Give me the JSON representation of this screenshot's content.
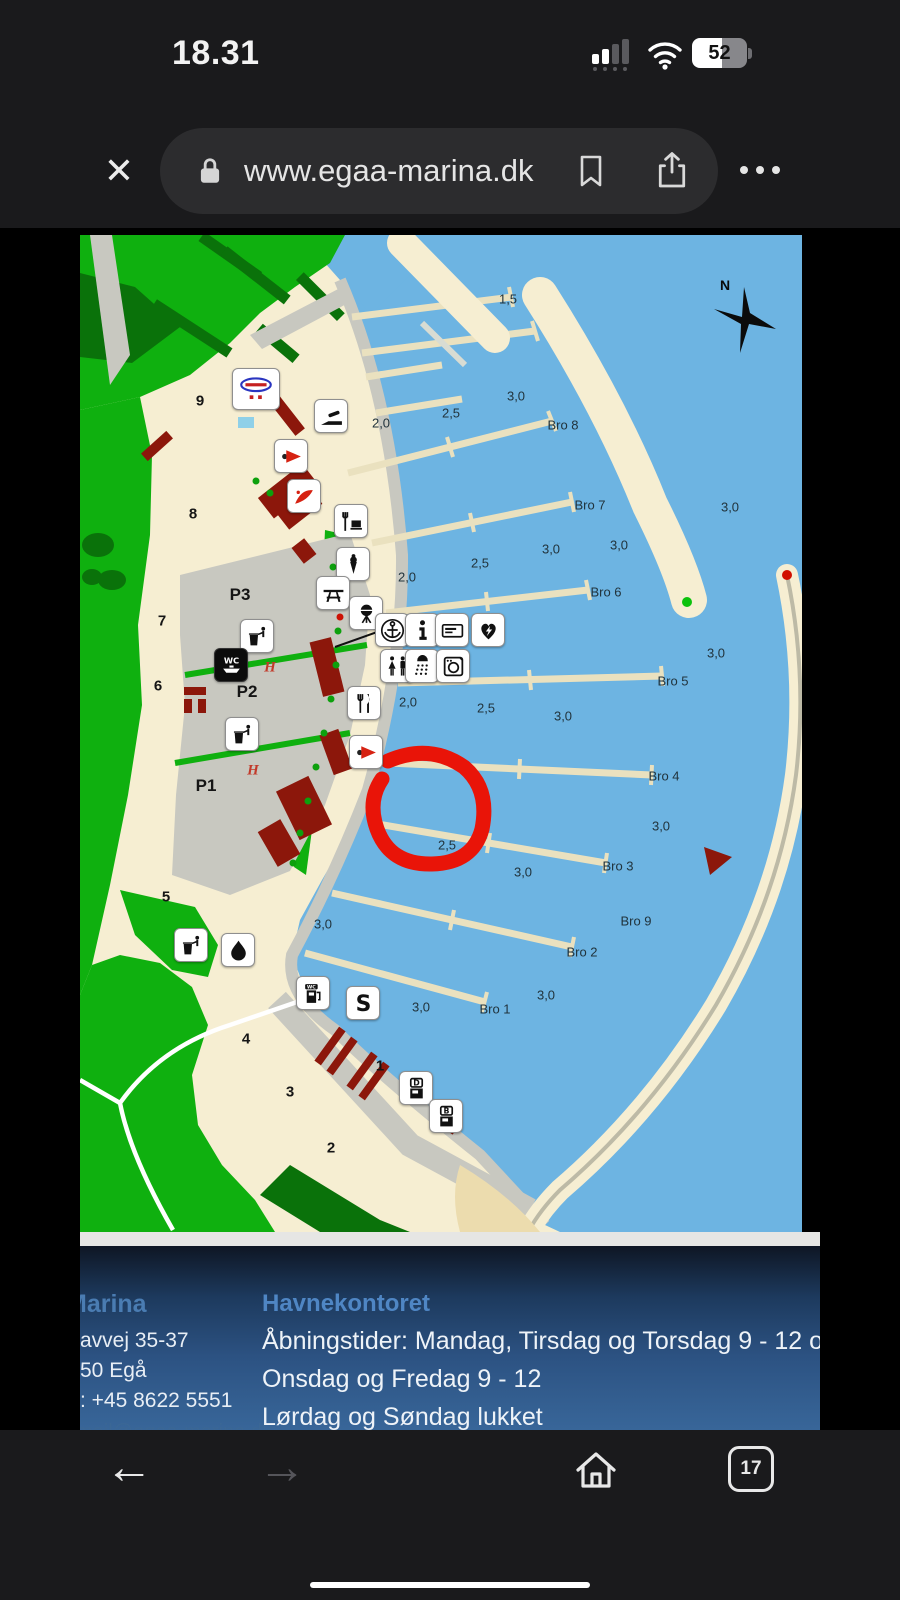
{
  "status_bar": {
    "time": "18.31",
    "battery_percent": "52"
  },
  "browser": {
    "url": "www.egaa-marina.dk"
  },
  "map": {
    "compass": "N",
    "h_marker": "H",
    "depths": [
      "1,5",
      "2,0",
      "2,5",
      "3,0",
      "3,0",
      "3,0",
      "3,0",
      "2,5",
      "2,0",
      "3,0",
      "3,0",
      "2,5",
      "2,0",
      "3,0",
      "3,0",
      "2,5",
      "3,0",
      "3,0",
      "3,0"
    ],
    "piers": [
      "Bro 8",
      "Bro 7",
      "Bro 6",
      "Bro 5",
      "Bro 4",
      "Bro 3",
      "Bro 9",
      "Bro 2",
      "Bro 1"
    ],
    "areas": [
      "9",
      "8",
      "7",
      "6",
      "5",
      "4",
      "3",
      "2",
      "1"
    ],
    "parking": [
      "P3",
      "P2",
      "P1"
    ],
    "icon_names": [
      "marina-logo-sign",
      "slipway-icon",
      "club-pennant-icon",
      "sailing-school-icon",
      "restaurant-cafe-icon",
      "ice-cream-icon",
      "picnic-table-icon",
      "grill-icon",
      "harbour-office-anchor-icon",
      "information-icon",
      "payment-card-icon",
      "defibrillator-icon",
      "toilets-icon",
      "shower-icon",
      "laundry-icon",
      "restaurant-icon",
      "club-pennant-2-icon",
      "waste-icon",
      "wc-pumpout-icon",
      "waste-2-icon",
      "waste-3-icon",
      "drinking-water-icon",
      "fuel-wc-pumpout-icon",
      "crane-hook-icon",
      "diesel-pump-icon",
      "benzin-pump-icon"
    ],
    "colors": {
      "water": "#6db4e2",
      "land": "#f6eed2",
      "green": "#0fb00f",
      "dark_green": "#0a720a",
      "gray": "#c8c8c0",
      "building": "#8c170b",
      "annotation": "#e91408"
    }
  },
  "footer": {
    "company": {
      "title": "Marina",
      "address1": "avvej 35-37",
      "address2": "50 Egå",
      "phone": ": +45 8622 5551",
      "email": "mail@egaa-marina.dk"
    },
    "office": {
      "title": "Havnekontoret",
      "hours1": "Åbningstider: Mandag, Tirsdag og Torsdag 9 - 12 og 13 - 1",
      "hours2": "Onsdag og Fredag 9 - 12",
      "hours3": "Lørdag og Søndag lukket",
      "hours4": "Derudover efter aftale"
    }
  },
  "nav": {
    "tab_count": "17"
  }
}
